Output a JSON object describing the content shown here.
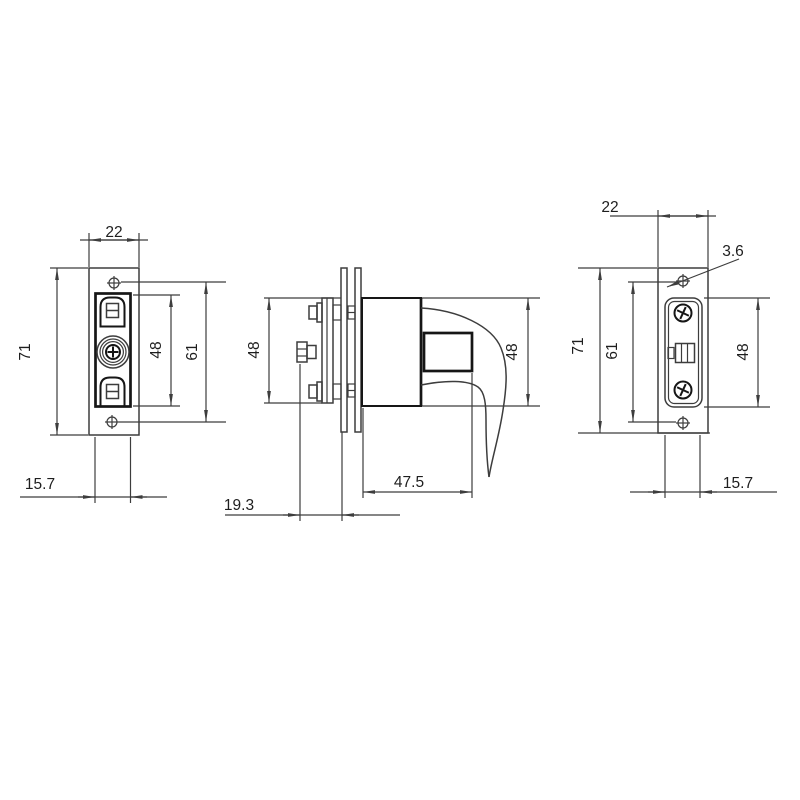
{
  "drawing": {
    "type": "engineering-three-view",
    "subject": "glass door showcase lock",
    "units": "mm",
    "dimensions": {
      "front": {
        "width": "22",
        "height": "71",
        "case_height": "48",
        "hole_spacing": "61",
        "plate_width": "15.7"
      },
      "side": {
        "plate_height": "48",
        "body_height": "48",
        "handle_depth": "47.5",
        "thumbturn_depth": "19.3"
      },
      "back": {
        "width": "22",
        "height": "71",
        "hole_spacing": "61",
        "strike_height": "48",
        "plate_width": "15.7",
        "hole_diameter": "3.6"
      }
    },
    "colors": {
      "line": "#3d3d3d",
      "bold": "#161616",
      "text": "#1e1e1e",
      "background": "#ffffff"
    }
  }
}
